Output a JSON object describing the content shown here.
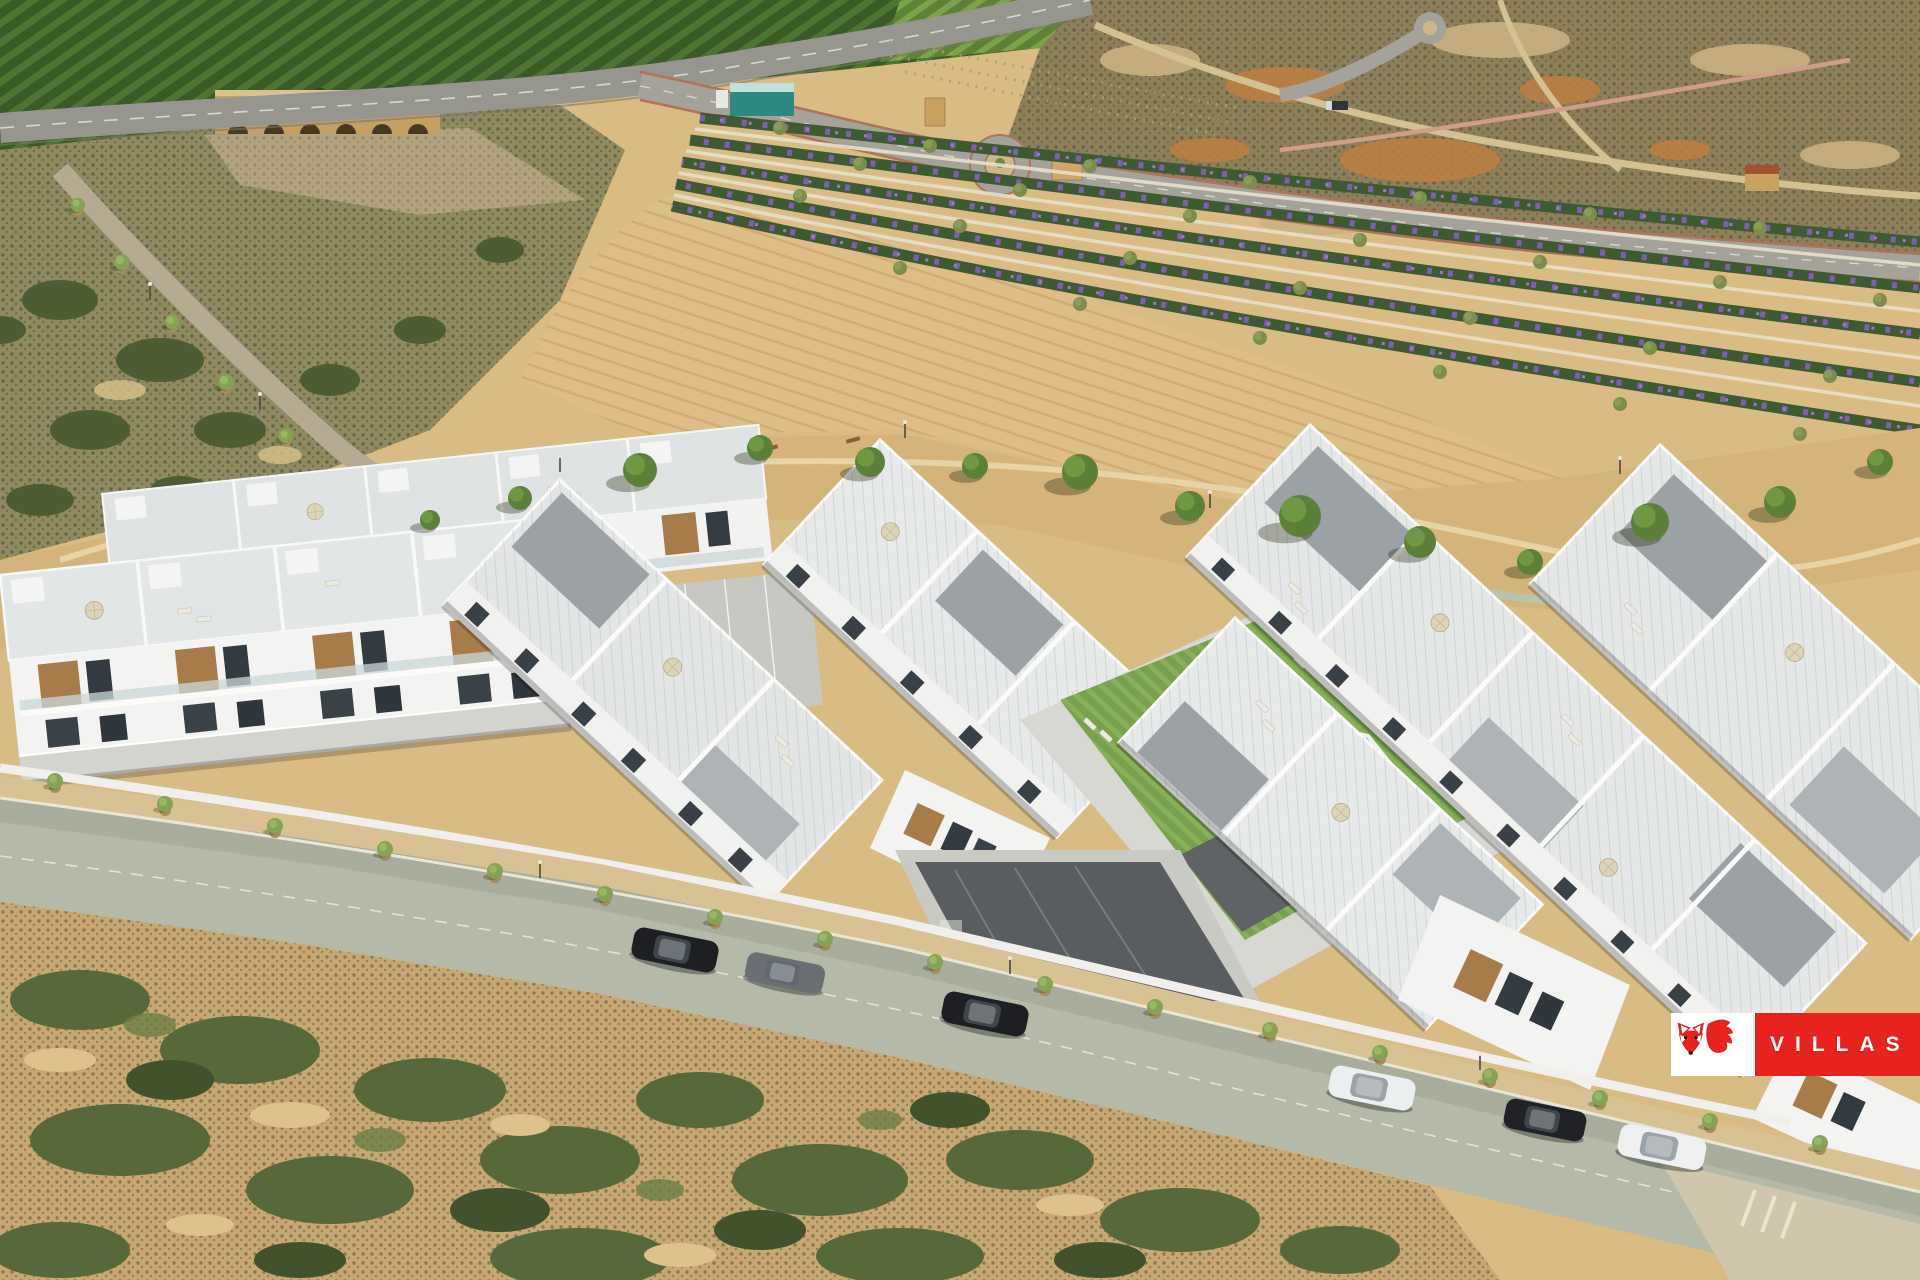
{
  "image": {
    "type": "aerial-photograph",
    "description": "Bright daylight aerial render of a modern white villa and apartment development with tiled rooftop terraces, parasols and a communal swimming pool, fronted by a tree-lined street with parked cars, surrounded by a dark green orchard, a highway with a stone arch bridge, sandy plowed fields, diagonal rows of purple flowering nursery shrubs, arid scrubland and coastal scrub",
    "lighting": "bright sunlight, shadows falling to the lower-left"
  },
  "logo": {
    "text": "VILLAS",
    "icon": "fox-icon",
    "band_color": "#E8231E",
    "box_color": "#FFFFFF",
    "text_color": "#FFFFFF"
  },
  "scene": {
    "regions": [
      {
        "name": "orchard-field",
        "color": "#3C5C28"
      },
      {
        "name": "vineyard-strip",
        "color": "#708F3E"
      },
      {
        "name": "highway",
        "color": "#97968E"
      },
      {
        "name": "stone-bridge",
        "color": "#C2A163"
      },
      {
        "name": "dry-riverbed",
        "color": "#B3A27F"
      },
      {
        "name": "arid-scrubland",
        "color": "#8D7F5A"
      },
      {
        "name": "landscaped-boulevard",
        "color": "#A5A399"
      },
      {
        "name": "roundabout",
        "color": "#A5A399"
      },
      {
        "name": "nursery-flower-rows",
        "colors": [
          "#3E5A33",
          "#7D5FAE"
        ]
      },
      {
        "name": "plowed-field",
        "color": "#DDBE86"
      },
      {
        "name": "tree-lined-promenade",
        "color": "#D5B47C"
      },
      {
        "name": "villa-development",
        "colors": [
          "#F3F3F1",
          "#DDE1E2",
          "#A87C48"
        ]
      },
      {
        "name": "swimming-pool",
        "color": "#4F9FA8"
      },
      {
        "name": "communal-lawn",
        "color": "#7CA04E"
      },
      {
        "name": "interior-driveway",
        "color": "#595D5F"
      },
      {
        "name": "front-street",
        "color": "#B4B9A8"
      },
      {
        "name": "coastal-scrub",
        "colors": [
          "#C7A773",
          "#57683B"
        ]
      }
    ],
    "pool": {
      "count": 1,
      "water_color": "#4F9FA8"
    },
    "vehicles": {
      "parked_cars": [
        {
          "color": "black",
          "type": "suv"
        },
        {
          "color": "gray",
          "type": "hatchback"
        },
        {
          "color": "black",
          "type": "sedan"
        },
        {
          "color": "white",
          "type": "sedan"
        },
        {
          "color": "black",
          "type": "sedan"
        },
        {
          "color": "white",
          "type": "suv"
        }
      ]
    }
  }
}
